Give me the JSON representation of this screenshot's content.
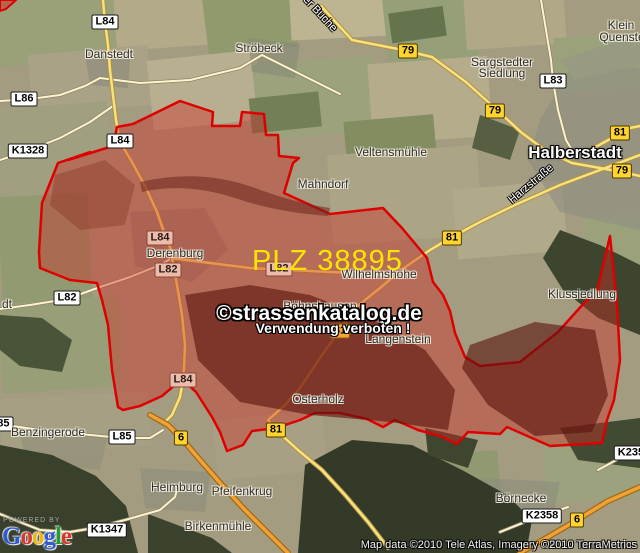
{
  "map": {
    "plz_label": "PLZ 38895",
    "plz_color": "#ffe400",
    "watermark_line1": "©strassenkatalog.de",
    "watermark_line2": "Verwendung verboten !",
    "attribution": "Map data ©2010 Tele Atlas, Imagery ©2010 TerraMetrics",
    "powered_by": "POWERED BY",
    "logo_letters": [
      {
        "ch": "G",
        "color": "#2f5bcf"
      },
      {
        "ch": "o",
        "color": "#d8372c"
      },
      {
        "ch": "o",
        "color": "#efb711"
      },
      {
        "ch": "g",
        "color": "#2f5bcf"
      },
      {
        "ch": "l",
        "color": "#269b32"
      },
      {
        "ch": "e",
        "color": "#d8372c"
      }
    ],
    "towns": [
      {
        "text": "Danstedt",
        "x": 109,
        "y": 54
      },
      {
        "text": "Ströbeck",
        "x": 259,
        "y": 48
      },
      {
        "text": "Klein",
        "x": 621,
        "y": 25
      },
      {
        "text": "Quenstedt",
        "x": 627,
        "y": 37
      },
      {
        "text": "Sargstedter",
        "x": 502,
        "y": 62
      },
      {
        "text": "Siedlung",
        "x": 502,
        "y": 73
      },
      {
        "text": "Veltensmühle",
        "x": 391,
        "y": 152
      },
      {
        "text": "Halberstadt",
        "x": 575,
        "y": 153,
        "variant": "city"
      },
      {
        "text": "Mahndorf",
        "x": 323,
        "y": 184
      },
      {
        "text": "Derenburg",
        "x": 175,
        "y": 253
      },
      {
        "text": "Wilhelmshöhe",
        "x": 379,
        "y": 274
      },
      {
        "text": "Klussiedlung",
        "x": 582,
        "y": 294
      },
      {
        "text": "Böhnshausen",
        "x": 320,
        "y": 306
      },
      {
        "text": "Langenstein",
        "x": 398,
        "y": 339
      },
      {
        "text": "Osterholz",
        "x": 318,
        "y": 399
      },
      {
        "text": "Benzingerode",
        "x": 48,
        "y": 432
      },
      {
        "text": "Heimburg",
        "x": 177,
        "y": 487
      },
      {
        "text": "Pfeifenkrug",
        "x": 242,
        "y": 491
      },
      {
        "text": "Birkenmühle",
        "x": 218,
        "y": 526
      },
      {
        "text": "Börnecke",
        "x": 521,
        "y": 498
      },
      {
        "text": "dt",
        "x": 7,
        "y": 304
      }
    ],
    "road_badges": [
      {
        "text": "L84",
        "x": 105,
        "y": 22,
        "variant": "white"
      },
      {
        "text": "L86",
        "x": 24,
        "y": 99,
        "variant": "white"
      },
      {
        "text": "K1328",
        "x": 28,
        "y": 151,
        "variant": "white"
      },
      {
        "text": "L84",
        "x": 120,
        "y": 141,
        "variant": "white"
      },
      {
        "text": "L83",
        "x": 553,
        "y": 81,
        "variant": "white"
      },
      {
        "text": "L82",
        "x": 67,
        "y": 298,
        "variant": "white"
      },
      {
        "text": "L85",
        "x": 0,
        "y": 424,
        "variant": "white"
      },
      {
        "text": "L85",
        "x": 122,
        "y": 437,
        "variant": "white"
      },
      {
        "text": "K1347",
        "x": 107,
        "y": 530,
        "variant": "white"
      },
      {
        "text": "K2358",
        "x": 542,
        "y": 516,
        "variant": "white"
      },
      {
        "text": "K2358",
        "x": 634,
        "y": 453,
        "variant": "white"
      },
      {
        "text": "L84",
        "x": 160,
        "y": 238,
        "variant": "pink"
      },
      {
        "text": "L82",
        "x": 279,
        "y": 269,
        "variant": "pink"
      },
      {
        "text": "L82",
        "x": 168,
        "y": 270,
        "variant": "pink"
      },
      {
        "text": "L84",
        "x": 183,
        "y": 380,
        "variant": "pink"
      },
      {
        "text": "79",
        "x": 408,
        "y": 51,
        "variant": "yellow"
      },
      {
        "text": "79",
        "x": 495,
        "y": 111,
        "variant": "yellow"
      },
      {
        "text": "79",
        "x": 622,
        "y": 171,
        "variant": "yellow"
      },
      {
        "text": "81",
        "x": 620,
        "y": 133,
        "variant": "yellow"
      },
      {
        "text": "81",
        "x": 452,
        "y": 238,
        "variant": "yellow"
      },
      {
        "text": "81",
        "x": 276,
        "y": 430,
        "variant": "yellow"
      },
      {
        "text": "81",
        "x": 340,
        "y": 331,
        "variant": "orange"
      },
      {
        "text": "6",
        "x": 181,
        "y": 438,
        "variant": "yellow"
      },
      {
        "text": "6",
        "x": 577,
        "y": 520,
        "variant": "yellow"
      }
    ],
    "road_labels": [
      {
        "text": "Harzstraße",
        "x": 531,
        "y": 184,
        "rotate": -40
      },
      {
        "text": "er Buche",
        "x": 320,
        "y": 14,
        "rotate": 47
      }
    ],
    "region_color_fill": "rgba(205,45,35,0.42)",
    "region_color_stroke": "#de0000",
    "region_points": "68,160 113,146 117,127 133,124 180,101 213,112 212,126 240,126 242,112 264,114 266,135 278,135 279,156 299,158 293,163 284,193 330,214 383,208 402,228 427,258 433,282 443,295 450,311 455,333 465,357 480,366 520,362 558,332 585,302 597,292 610,236 617,305 620,360 614,400 607,420 602,443 550,446 507,427 500,434 468,432 457,444 440,436 418,430 395,420 383,427 367,419 340,413 315,413 300,420 276,428 252,431 243,445 227,451 220,432 212,417 196,392 182,379 162,396 140,406 123,410 118,407 112,370 108,325 102,300 97,283 70,280 40,268 39,252 42,203 58,163 90,152"
  }
}
